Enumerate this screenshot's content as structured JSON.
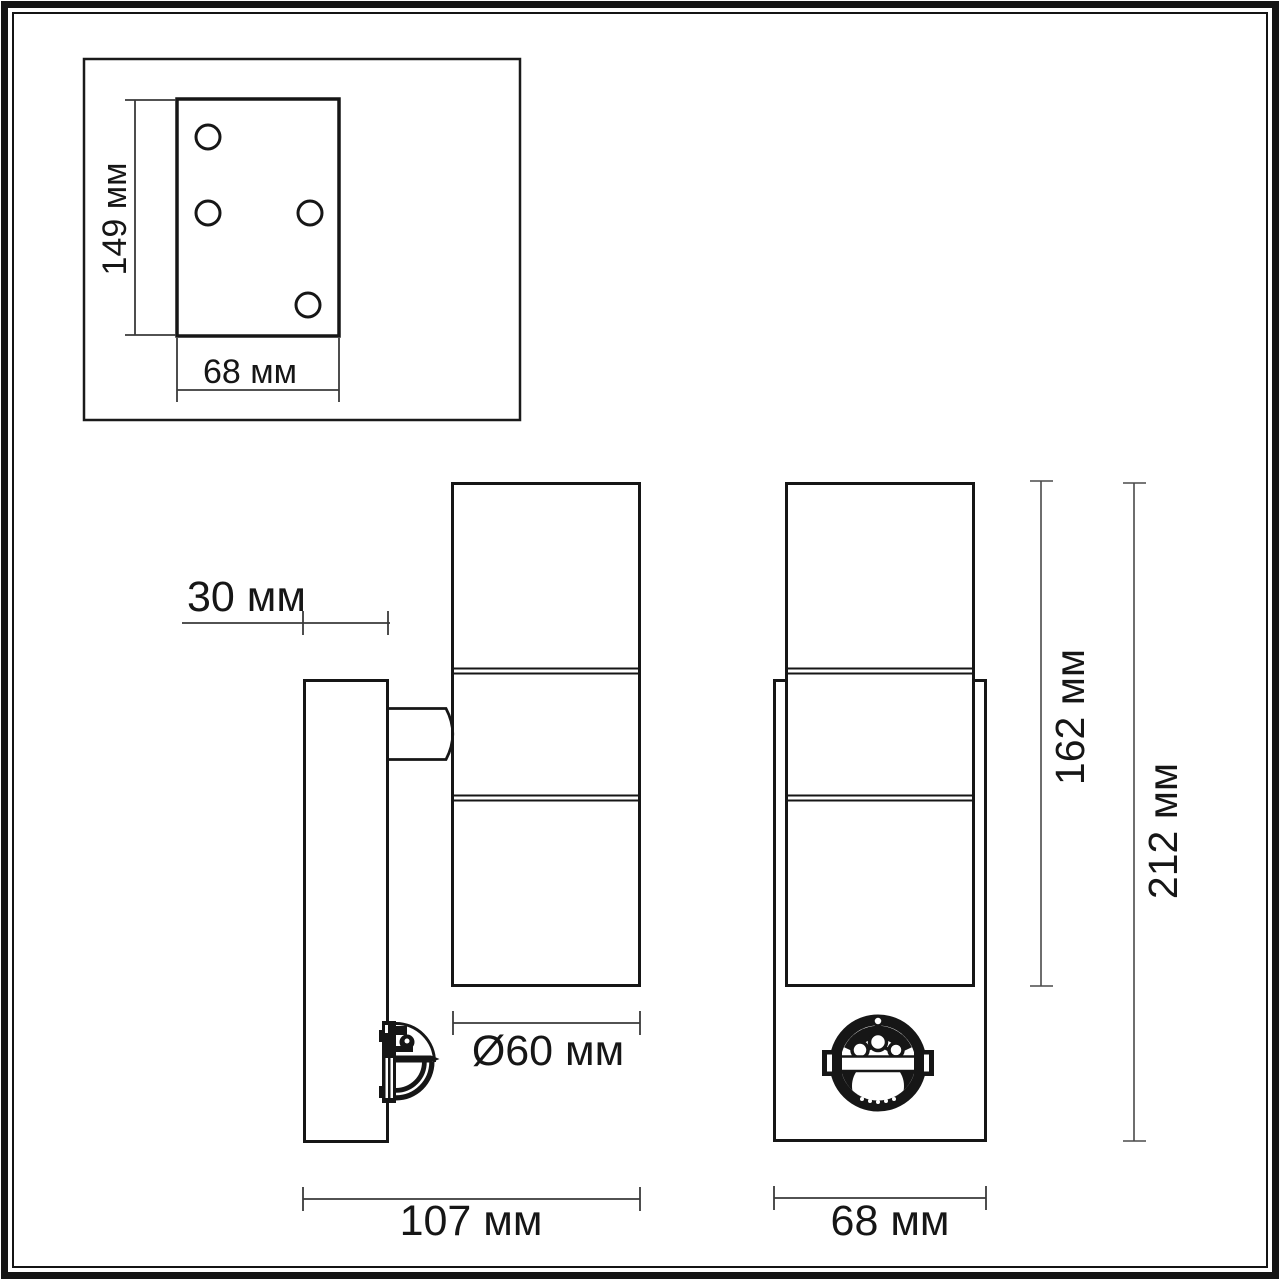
{
  "page": {
    "background": "#ffffff",
    "line_color": "#161616",
    "dim_line_color": "#3a3a3a"
  },
  "views": {
    "mounting_plate_top": {
      "description": "mounting plate with four screw holes",
      "dim_height": "149 мм",
      "dim_width": "68 мм",
      "hole_count": 4
    },
    "side": {
      "description": "side profile of wall lamp with motion sensor",
      "dim_wall_plate_depth": "30 мм",
      "dim_diameter": "Ø60 мм",
      "dim_total_depth": "107 мм"
    },
    "front": {
      "description": "front view of cylinder lamp on backplate with motion sensor",
      "dim_body_height": "162 мм",
      "dim_total_height": "212 мм",
      "dim_width": "68 мм"
    }
  },
  "icons": {
    "motion_sensor_front": "circular PIR sensor face",
    "motion_sensor_side": "PIR sensor dome profile"
  }
}
